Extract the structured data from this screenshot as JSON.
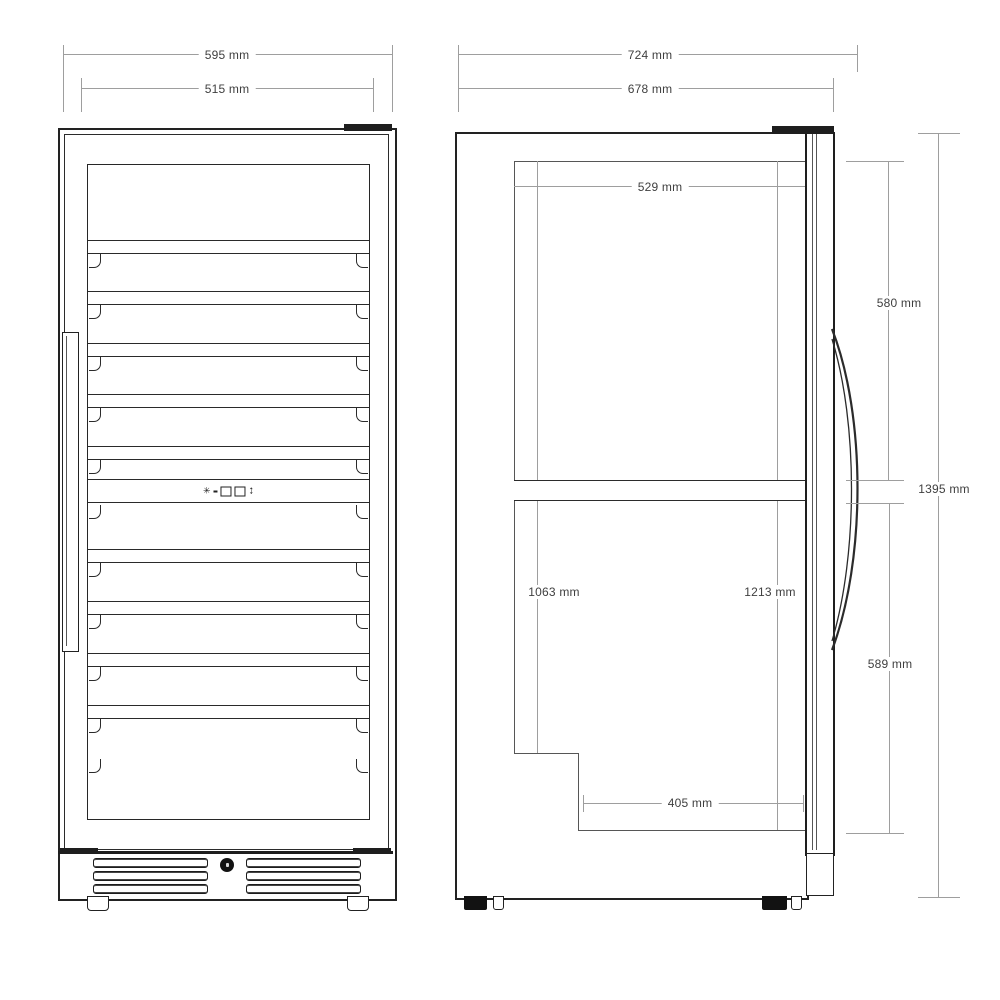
{
  "drawing": {
    "type": "technical dimension drawing",
    "subject": "wine cooler cabinet, front and side elevation"
  },
  "front_view": {
    "dim_overall_width": "595 mm",
    "dim_inner_width": "515 mm",
    "upper_shelf_count": 5,
    "lower_shelf_count": 4,
    "vent_slat_rows": 3,
    "vent_groups": 2
  },
  "side_view": {
    "dim_overall_depth": "724 mm",
    "dim_body_depth": "678 mm",
    "dim_interior_depth": "529 mm",
    "dim_upper_zone_height": "580 mm",
    "dim_total_height": "1395 mm",
    "dim_interior_height_rear": "1063 mm",
    "dim_interior_height_front": "1213 mm",
    "dim_lower_zone_height": "589 mm",
    "dim_base_depth": "405 mm"
  },
  "control_panel": {
    "icons": [
      "asterisk",
      "dash",
      "square",
      "square",
      "up-down-arrows"
    ]
  }
}
